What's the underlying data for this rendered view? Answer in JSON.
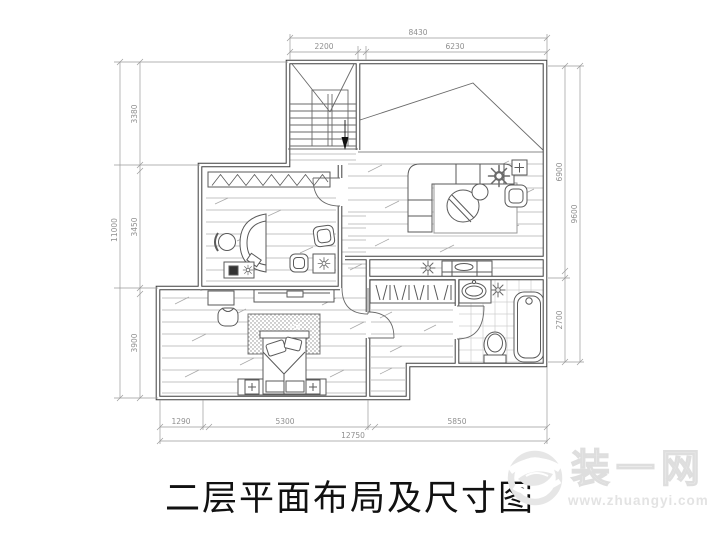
{
  "title": {
    "text": "二层平面布局及尺寸图"
  },
  "watermark": {
    "brand": "装一网",
    "url": "www.zhuangyi.com"
  },
  "dimensions": {
    "top": {
      "segments": [
        "2200",
        "6230"
      ],
      "total": "8430"
    },
    "left": {
      "segments": [
        "3380",
        "3450",
        "3900"
      ],
      "total": "11000"
    },
    "right": {
      "segments": [
        "6900",
        "2700"
      ],
      "total": "9600"
    },
    "bottom": {
      "segments": [
        "1290",
        "5300",
        "5850"
      ],
      "total": "12750"
    }
  },
  "plan": {
    "type": "second-floor layout and dimension plan",
    "elements": [
      "staircase",
      "stair-down-arrow",
      "sloped-roof-void",
      "living-area",
      "corner-sofa",
      "coffee-table",
      "armchair",
      "side-table",
      "plant",
      "rug",
      "study",
      "curved-desk",
      "office-chair",
      "desk-cabinet",
      "guest-chairs",
      "closet-hatch-band",
      "hallway-cabinet",
      "ceiling-lamp",
      "bedroom",
      "bed",
      "pillows",
      "bedside-rug",
      "tv-bench",
      "dresser",
      "stool",
      "walk-in-closet",
      "clothes-hangers",
      "bathroom",
      "sink",
      "toilet",
      "bathtub",
      "tile-floor",
      "doors",
      "dimension-lines"
    ]
  },
  "colors": {
    "wall_line": "#3f3f3f",
    "furniture_line": "#5a5a5a",
    "floor_hatch": "#b0b0b0",
    "dimension": "#8f8f8f",
    "watermark": "#e6e6e6",
    "title_text": "#111111"
  }
}
